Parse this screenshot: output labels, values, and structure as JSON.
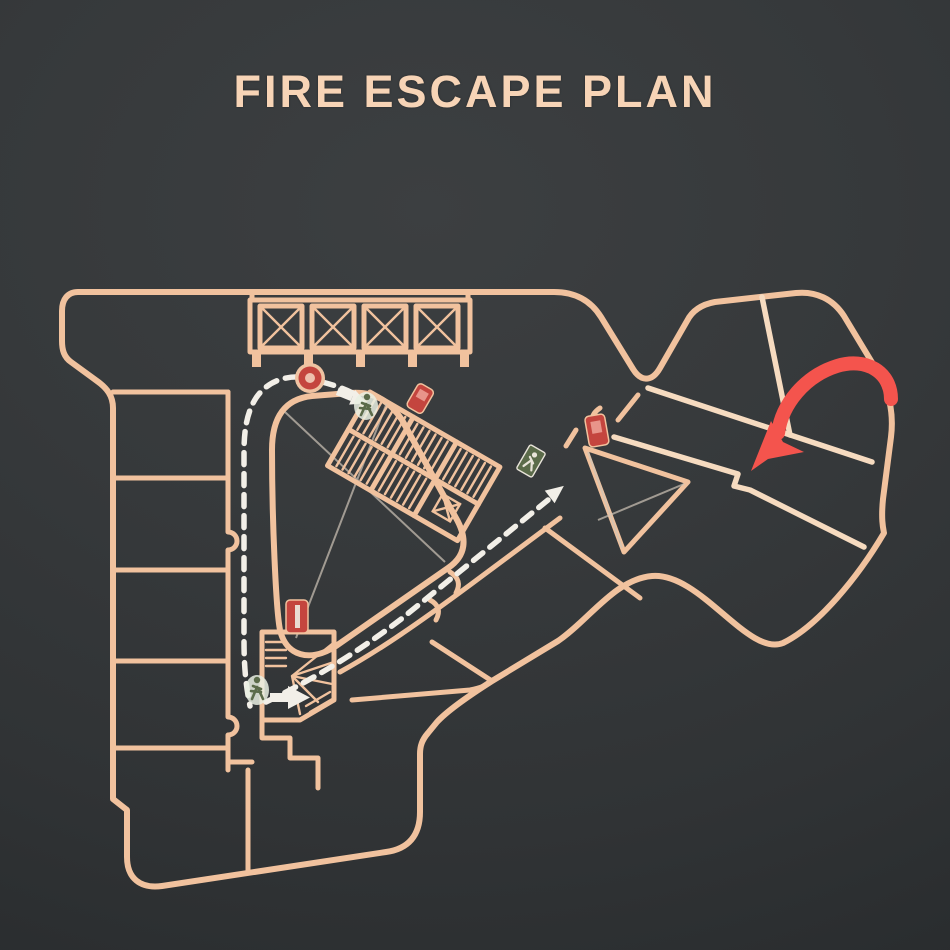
{
  "header": {
    "title": "FIRE ESCAPE PLAN"
  },
  "colors": {
    "title": "#f7d4b6",
    "background": "#35383a",
    "background_edge": "#282b2d",
    "wall": "#f1c29e",
    "wall_bright": "#f6dbc0",
    "thin_line": "#cfc4b8",
    "route": "#f2efe8",
    "pointer_arrow": "#f4544d",
    "fire_equipment": "#c4453e",
    "exit_green": "#5b6b4a"
  },
  "plan": {
    "kind": "building-floor-evacuation-plan",
    "route_style": "white-dashed-line",
    "icons": [
      {
        "name": "fire-alarm-point",
        "shape": "red-ring-circle",
        "location": "top-corridor"
      },
      {
        "name": "fire-extinguisher-upper",
        "shape": "red-box",
        "location": "upper-staircase"
      },
      {
        "name": "fire-extinguisher-right",
        "shape": "red-box",
        "location": "right-wing-junction"
      },
      {
        "name": "fire-extinguisher-lower",
        "shape": "red-box",
        "location": "lower-staircase"
      },
      {
        "name": "exit-sign",
        "shape": "green-box-running-man",
        "location": "diagonal-corridor"
      },
      {
        "name": "running-person-upper",
        "shape": "green-figure",
        "location": "upper-staircase-entry"
      },
      {
        "name": "running-person-lower",
        "shape": "green-figure",
        "location": "lower-exit-corridor"
      },
      {
        "name": "you-are-here-arrow",
        "shape": "red-curved-arrow",
        "location": "right-wing"
      }
    ],
    "features": [
      {
        "name": "elevator-bank",
        "shaft_count": 4
      },
      {
        "name": "atrium-void",
        "marking": "thin-cross-lines"
      },
      {
        "name": "stair-triangle-room",
        "marking": "thin-cross-lines"
      },
      {
        "name": "upper-staircase",
        "marking": "hatched-steps"
      },
      {
        "name": "lower-winding-staircase",
        "marking": "fan-steps"
      },
      {
        "name": "escape-route",
        "style": "white-dashed"
      },
      {
        "name": "direction-arrows",
        "style": "solid-white"
      }
    ]
  }
}
